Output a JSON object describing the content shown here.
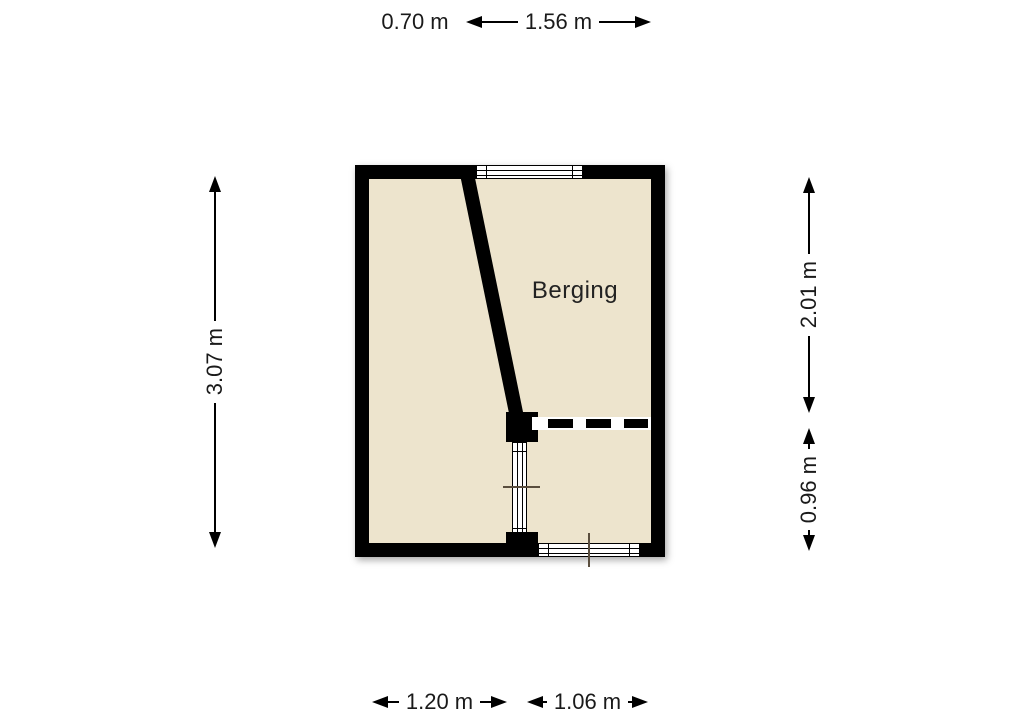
{
  "room": {
    "label": "Berging"
  },
  "dims": {
    "top_070": "0.70 m",
    "top_156": "1.56 m",
    "left_307": "3.07 m",
    "right_201": "2.01 m",
    "right_096": "0.96 m",
    "bottom_120": "1.20 m",
    "bottom_106": "1.06 m"
  },
  "colors": {
    "background": "#ffffff",
    "floor": "#ede4cd",
    "wall": "#000000",
    "window": "#ffffff",
    "marker": "#5a4e3e",
    "text": "#1a1a1a"
  }
}
